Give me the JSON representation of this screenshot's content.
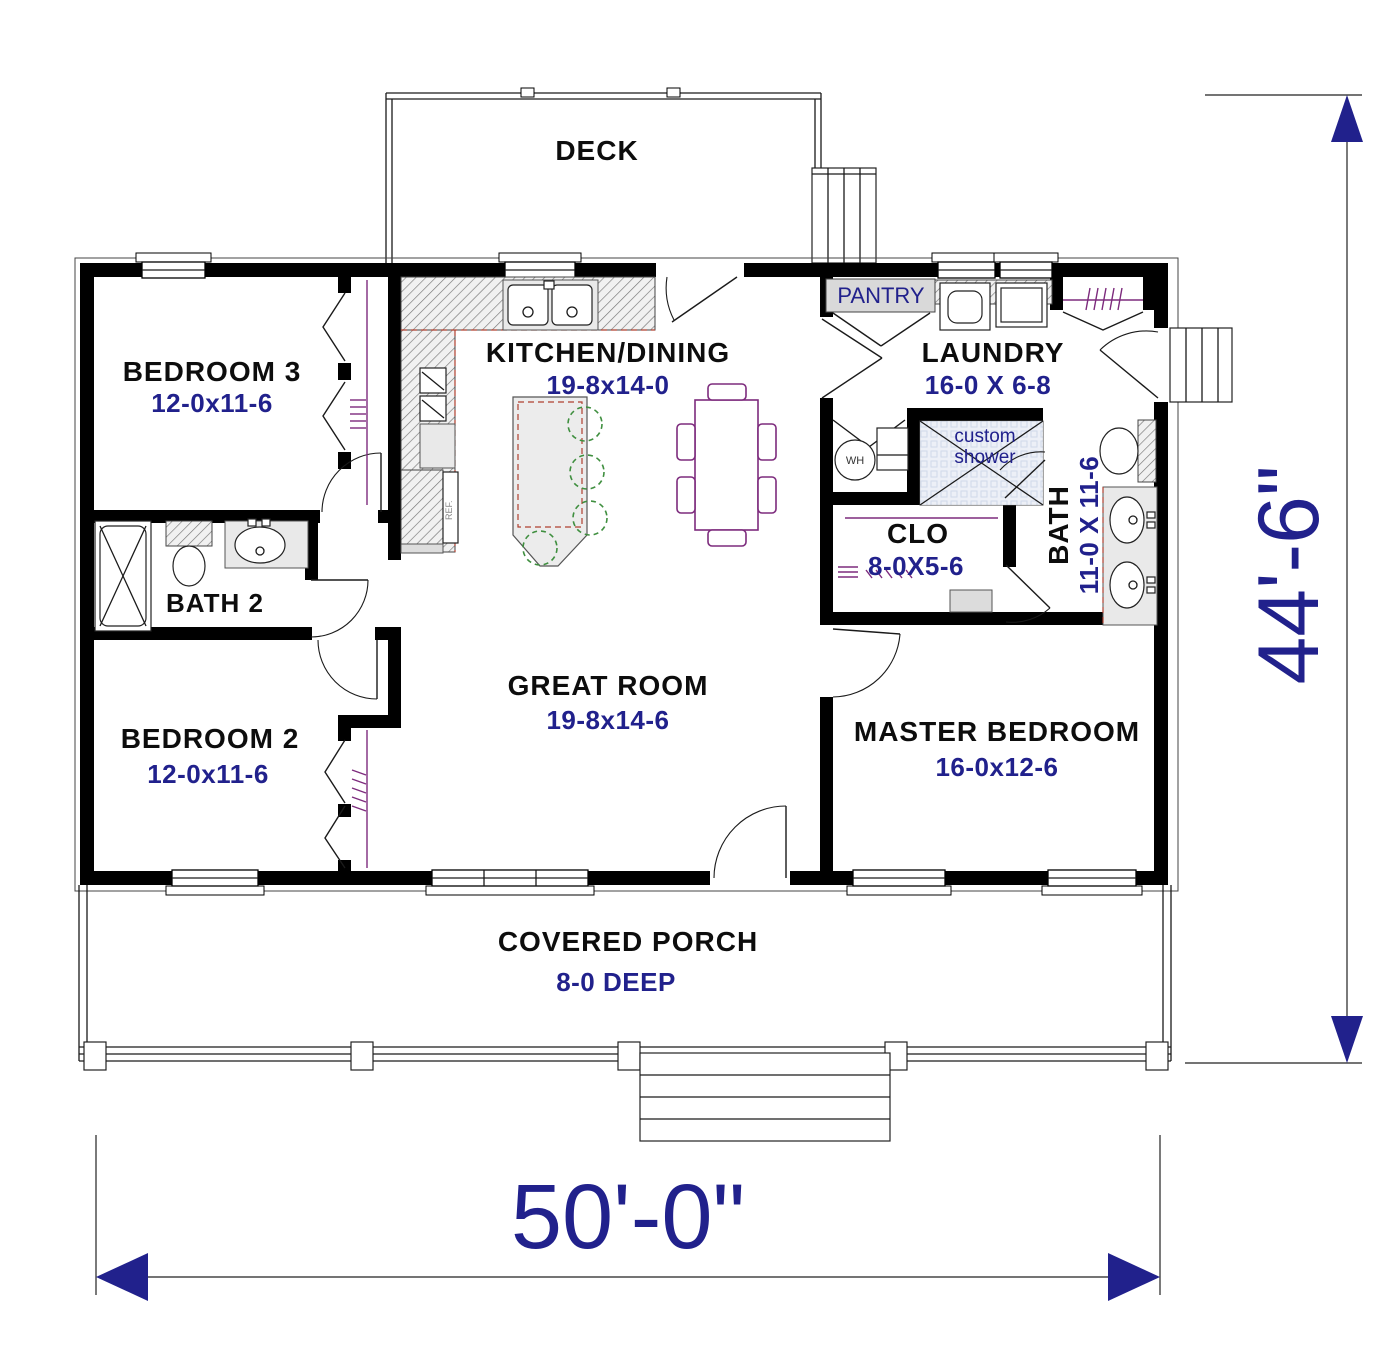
{
  "rooms": {
    "deck": {
      "name": "DECK"
    },
    "bedroom3": {
      "name": "BEDROOM 3",
      "dims": "12-0x11-6"
    },
    "kitchen": {
      "name": "KITCHEN/DINING",
      "dims": "19-8x14-0"
    },
    "pantry": {
      "name": "PANTRY"
    },
    "laundry": {
      "name": "LAUNDRY",
      "dims": "16-0 X 6-8"
    },
    "bath2": {
      "name": "BATH 2"
    },
    "closet": {
      "name": "CLO",
      "dims": "8-0X5-6"
    },
    "master_bath": {
      "name": "BATH",
      "dims": "11-0 X 11-6"
    },
    "custom_shower": {
      "line1": "custom",
      "line2": "shower"
    },
    "great_room": {
      "name": "GREAT ROOM",
      "dims": "19-8x14-6"
    },
    "bedroom2": {
      "name": "BEDROOM 2",
      "dims": "12-0x11-6"
    },
    "master_bedroom": {
      "name": "MASTER BEDROOM",
      "dims": "16-0x12-6"
    },
    "covered_porch": {
      "name": "COVERED PORCH",
      "dims": "8-0 DEEP"
    }
  },
  "labels": {
    "water_heater": "WH",
    "refrigerator": "REF."
  },
  "overall_dimensions": {
    "width": "50'-0\"",
    "height": "44'-6\""
  },
  "colors": {
    "wall": "#000000",
    "room_name_text": "#0d0d0d",
    "dimension_text": "#21218c",
    "closet_fixture": "#7d2b7d",
    "stool": "#3f8f3f",
    "counter_edge": "#b04030",
    "pantry_fill": "#d9d9d9",
    "shower_fill": "#e7ecf4"
  }
}
